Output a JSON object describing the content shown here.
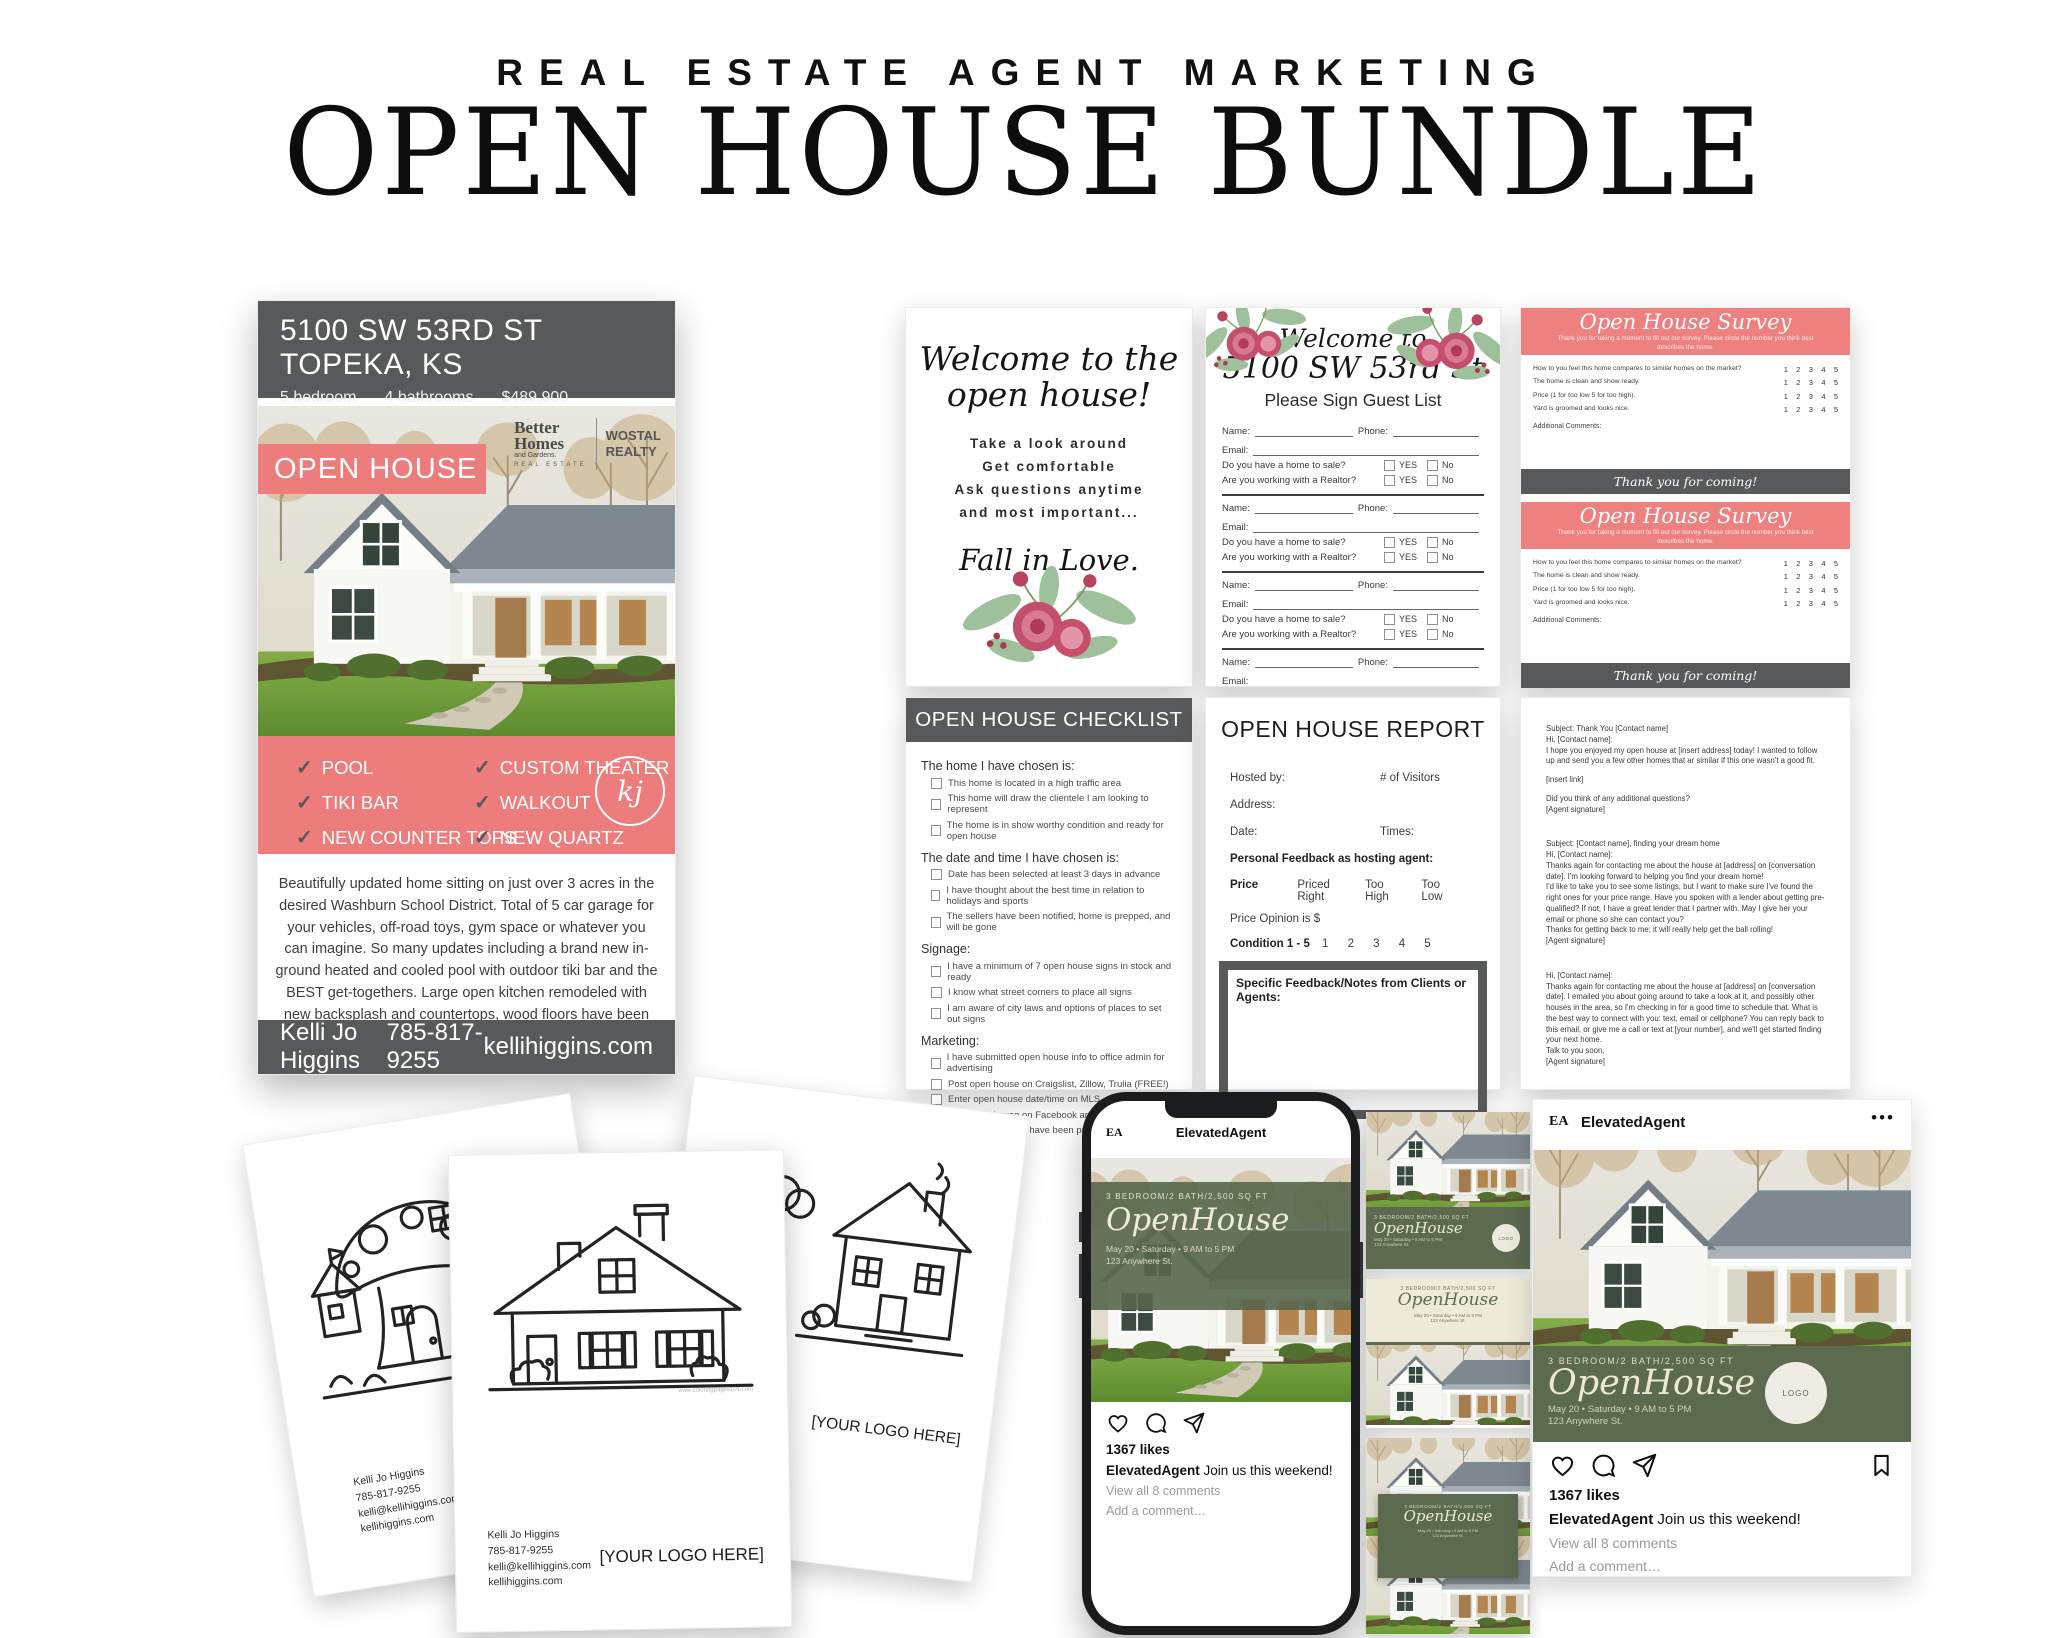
{
  "header": {
    "kicker": "REAL ESTATE AGENT MARKETING",
    "title": "OPEN HOUSE BUNDLE"
  },
  "colors": {
    "coral": "#ed7d7d",
    "dark_gray": "#58595b",
    "olive_green": "#5c6a50",
    "cream": "#edead9"
  },
  "flyer": {
    "address": "5100 SW 53RD ST TOPEKA, KS",
    "beds": "5 bedroom",
    "baths": "4 bathrooms",
    "price": "$489,900",
    "banner": "OPEN HOUSE",
    "brokerage": {
      "b1": "Better",
      "b2": "Homes",
      "b3": "and Gardens.",
      "b4": "REAL ESTATE",
      "w1": "WOSTAL",
      "w2": "REALTY"
    },
    "badge": "kj",
    "features_left": [
      "POOL",
      "TIKI BAR",
      "NEW COUNTER TOPS"
    ],
    "features_right": [
      "CUSTOM THEATER",
      "WALKOUT",
      "NEW QUARTZ"
    ],
    "description": "Beautifully updated home sitting on just over 3 acres in the desired Washburn School District. Total of 5 car garage for your vehicles, off-road toys, gym space or whatever you can imagine. So many updates including a brand new in-ground heated and cooled pool with outdoor tiki bar and the BEST get-togethers. Large open kitchen remodeled with new backsplash and countertops, wood floors have been refinished to a beautiful gray wash, new carpet, new tile and quartz hearth on the fireplace.",
    "agent": "Kelli Jo Higgins",
    "phone": "785-817-9255",
    "website": "kellihiggins.com"
  },
  "welcome_card": {
    "title1": "Welcome to the",
    "title2": "open house!",
    "line1": "Take a look around",
    "line2": "Get comfortable",
    "line3": "Ask questions anytime",
    "line4": "and most important...",
    "script": "Fall in Love."
  },
  "guest_list": {
    "heading1": "Welcome to",
    "heading2": "5100 SW 53rd St",
    "subheading": "Please Sign Guest List",
    "entry": {
      "name": "Name:",
      "phone": "Phone:",
      "email": "Email:",
      "q1": "Do you have a home to sale?",
      "q2": "Are you working with a Realtor?",
      "yes": "YES",
      "no": "No"
    }
  },
  "survey": {
    "title": "Open House Survey",
    "intro": "Thank you for taking a moment to fill out our survey.  Please circle the number you think best describes the home.",
    "questions": [
      "How to you feel this home compares to similar homes on the market?",
      "The home is clean and show ready.",
      "Price (1 for too low 5 for too high).",
      "Yard is groomed and looks nice."
    ],
    "scale": "1    2    3    4    5",
    "comments": "Additional Comments:",
    "footer": "Thank you for coming!"
  },
  "checklist": {
    "title": "OPEN HOUSE CHECKLIST",
    "sections": [
      {
        "heading": "The home I have chosen is:",
        "items": [
          "This home is located in a high traffic area",
          "This home will draw the clientele I am looking to represent",
          "The home is in show worthy condition and ready for open house"
        ]
      },
      {
        "heading": "The date and time I have chosen is:",
        "items": [
          "Date has been selected at least 3 days in advance",
          "I have thought about the best time in relation to holidays and sports",
          "The sellers have been notified, home is prepped, and will be gone"
        ]
      },
      {
        "heading": "Signage:",
        "items": [
          "I have a minimum of 7 open house signs in stock and ready",
          "I know what street corners to place all signs",
          "I am aware of city laws and options of places to set out signs"
        ]
      },
      {
        "heading": "Marketing:",
        "items": [
          "I have submitted open house info to office admin for advertising",
          "Post open house on Craigslist, Zillow, Trulia (FREE!)",
          "Enter open house date/time on MLS",
          "Post open house on Facebook and boost post",
          "Open House flyers have been printed and ready to go"
        ]
      }
    ]
  },
  "report": {
    "title": "OPEN HOUSE REPORT",
    "hosted_by": "Hosted by:",
    "visitors": "# of Visitors",
    "address": "Address:",
    "date": "Date:",
    "times": "Times:",
    "feedback_heading": "Personal Feedback as hosting agent:",
    "price_label": "Price",
    "price_opt1": "Priced Right",
    "price_opt2": "Too High",
    "price_opt3": "Too Low",
    "price_opinion": "Price Opinion is  $",
    "condition_label": "Condition 1 - 5",
    "condition_scale": "1      2      3      4      5",
    "notes_label": "Specific Feedback/Notes from Clients or Agents:"
  },
  "emails": {
    "e1": [
      "Subject: Thank You [Contact name]",
      "Hi, [Contact name]:",
      "I hope you enjoyed my open house at [insert address] today! I wanted to follow up and send you a few other homes that ar similar if this one wasn't a good fit.",
      "[insert link]",
      "Did you think of any additional questions?",
      "[Agent signature]"
    ],
    "e2": [
      "Subject: [Contact name], finding your dream home",
      "Hi, [Contact name]:",
      "Thanks again for contacting me about the house at [address] on [conversation date]. I'm looking forward to helping you find your dream home!",
      "I'd like to take you to see some listings, but I want to make sure I've found the right ones for your price range. Have you spoken with a lender about getting pre-qualified? If not, I have a great lender that I partner with. May I give her your email or phone so she can contact you?",
      "Thanks for getting back to me; it will really help get the ball rolling!",
      "[Agent signature]"
    ],
    "e3": [
      "Hi, [Contact name]:",
      "Thanks again for contacting me about the house at [address] on [conversation date]. I emailed you about going around to take a look at it, and possibly other houses in the area, so I'm checking in for a good time to schedule that. What is the best way to connect with you: text, email or cellphone? You can reply back to this email, or give me a call or text at [your number], and we'll get started finding your next home.",
      "Talk to you soon,",
      "[Agent signature]"
    ]
  },
  "coloring": {
    "contact1": "Kelli Jo Higgins",
    "contact2": "785-817-9255",
    "contact3": "kelli@kellihiggins.com",
    "contact4": "kellihiggins.com",
    "logo_placeholder": "[YOUR LOGO HERE]",
    "watermark": "www.coloringpages101.com"
  },
  "social": {
    "account": "ElevatedAgent",
    "logo": "EA",
    "menu": "•••",
    "specs": "3 BEDROOM/2 BATH/2,500 SQ FT",
    "title": "OpenHouse",
    "datetime": "May 20 • Saturday • 9 AM to 5 PM",
    "address": "123 Anywhere St.",
    "likes": "1367 likes",
    "caption_user": "ElevatedAgent",
    "caption_text": " Join us this weekend!",
    "view_comments": "View all 8 comments",
    "add_comment": "Add a comment…",
    "logo_circle": "LOGO"
  }
}
